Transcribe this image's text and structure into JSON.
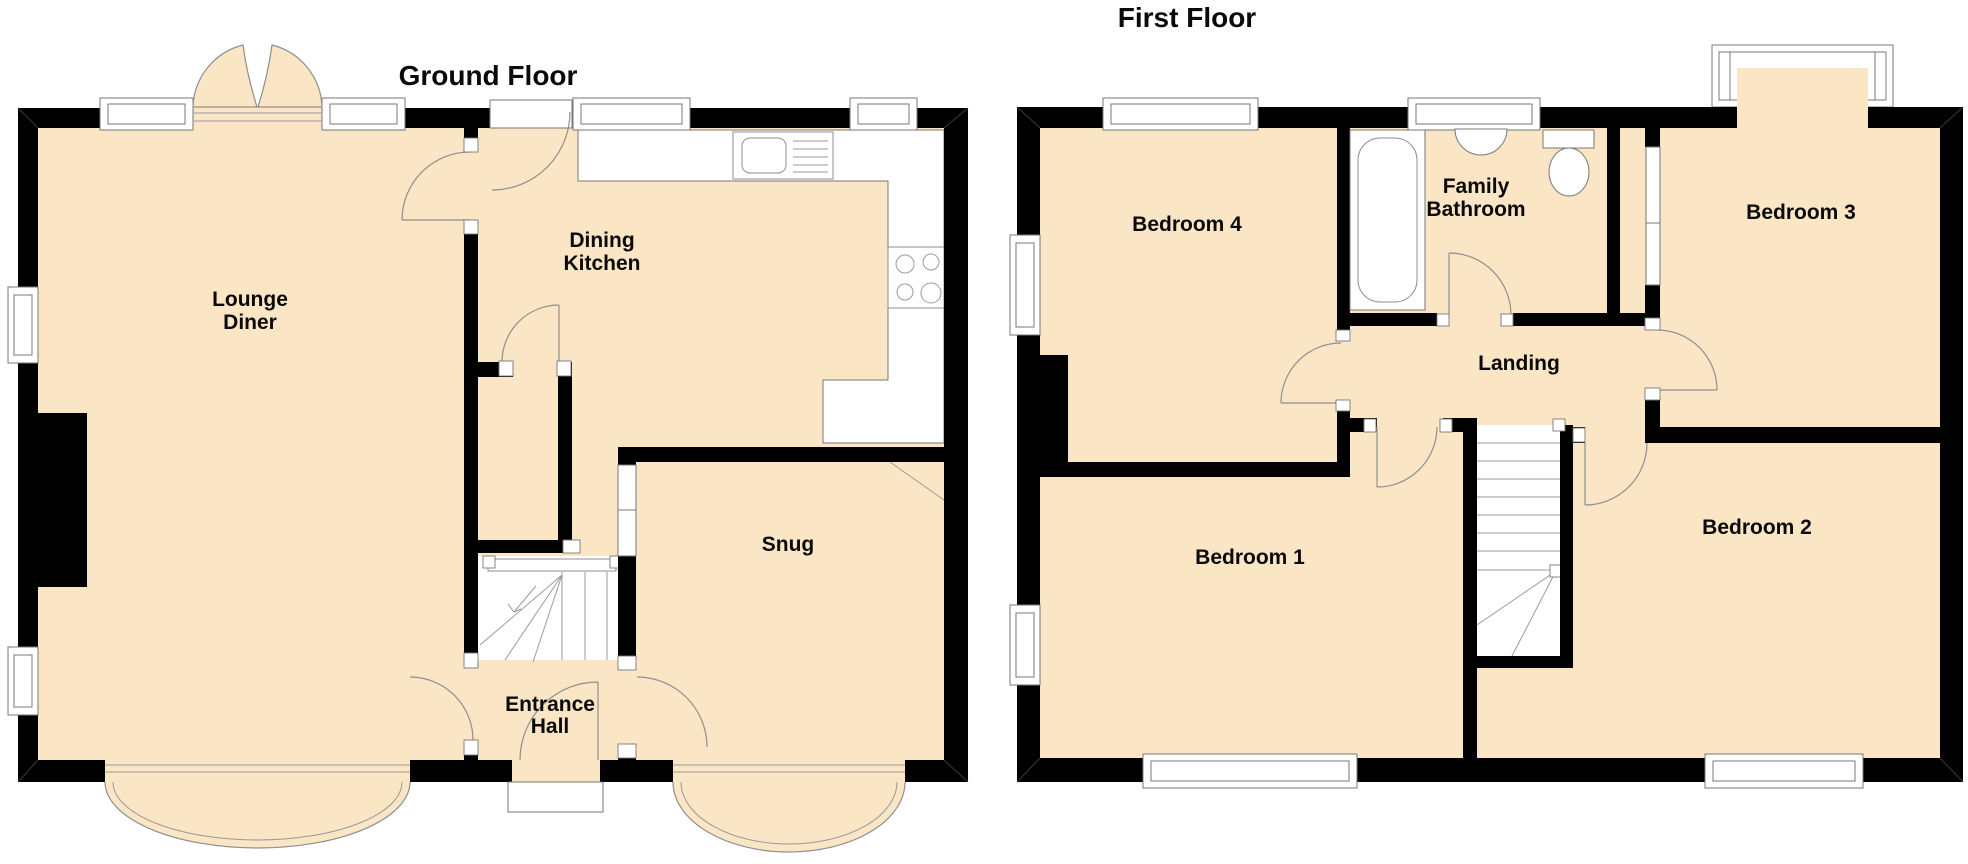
{
  "document": {
    "kind": "estate-agent floor plan",
    "background": "#ffffff"
  },
  "colors": {
    "floor_fill": "#fae5c5",
    "wall": "#000000",
    "detail_line": "#8f8f8f",
    "fixture_fill": "#ffffff",
    "label_text": "#0a0a0a"
  },
  "ground": {
    "title": "Ground Floor",
    "rooms": {
      "lounge_diner": {
        "line1": "Lounge",
        "line2": "Diner"
      },
      "dining_kitchen": {
        "line1": "Dining",
        "line2": "Kitchen"
      },
      "snug": {
        "label": "Snug"
      },
      "entrance_hall": {
        "line1": "Entrance",
        "line2": "Hall"
      }
    },
    "fixtures": [
      "double-patio-doors",
      "sink-drainer-icon",
      "hob-icon",
      "kitchen-counter",
      "staircase",
      "front-door",
      "door-step",
      "bay-window-left",
      "bay-window-right",
      "chimney-breast"
    ]
  },
  "first": {
    "title": "First Floor",
    "rooms": {
      "bedroom4": {
        "label": "Bedroom 4"
      },
      "family_bathroom": {
        "line1": "Family",
        "line2": "Bathroom"
      },
      "bedroom3": {
        "label": "Bedroom 3"
      },
      "landing": {
        "label": "Landing"
      },
      "bedroom1": {
        "label": "Bedroom 1"
      },
      "bedroom2": {
        "label": "Bedroom 2"
      }
    },
    "fixtures": [
      "bath-icon",
      "basin-icon",
      "toilet-icon",
      "staircase",
      "built-in-cupboard",
      "projecting-bay-window",
      "chimney-breast"
    ]
  }
}
